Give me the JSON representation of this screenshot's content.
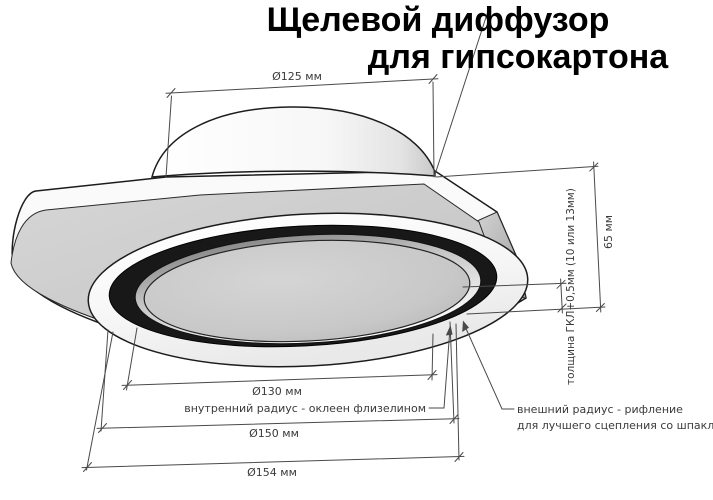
{
  "title": {
    "line1": "Щелевой диффузор",
    "line2": "для гипсокартона"
  },
  "dimensions": {
    "collar_diameter": "Ø125 мм",
    "height": "65 мм",
    "board_thickness": "толщина ГКЛ+0,5мм (10 или 13мм)",
    "inner_diameter": "Ø130 мм",
    "ring_diameter": "Ø150 мм",
    "outer_diameter": "Ø154 мм"
  },
  "annotations": {
    "inner_radius": "внутренний радиус - оклеен флизелином",
    "outer_radius_line1": "внешний радиус - рифление",
    "outer_radius_line2": "для лучшего сцепления со шпаклёвкой"
  },
  "colors": {
    "background": "#ffffff",
    "title_text": "#000000",
    "dimension_lines": "#4a4a4a",
    "dimension_text": "#3a3a3a",
    "plate_face": "#cbcbcb",
    "plate_edge": "#fafafa",
    "slot_ring": "#181818",
    "diffuser_disc": "#c8c8c8",
    "collar": "#f6f6f6"
  }
}
